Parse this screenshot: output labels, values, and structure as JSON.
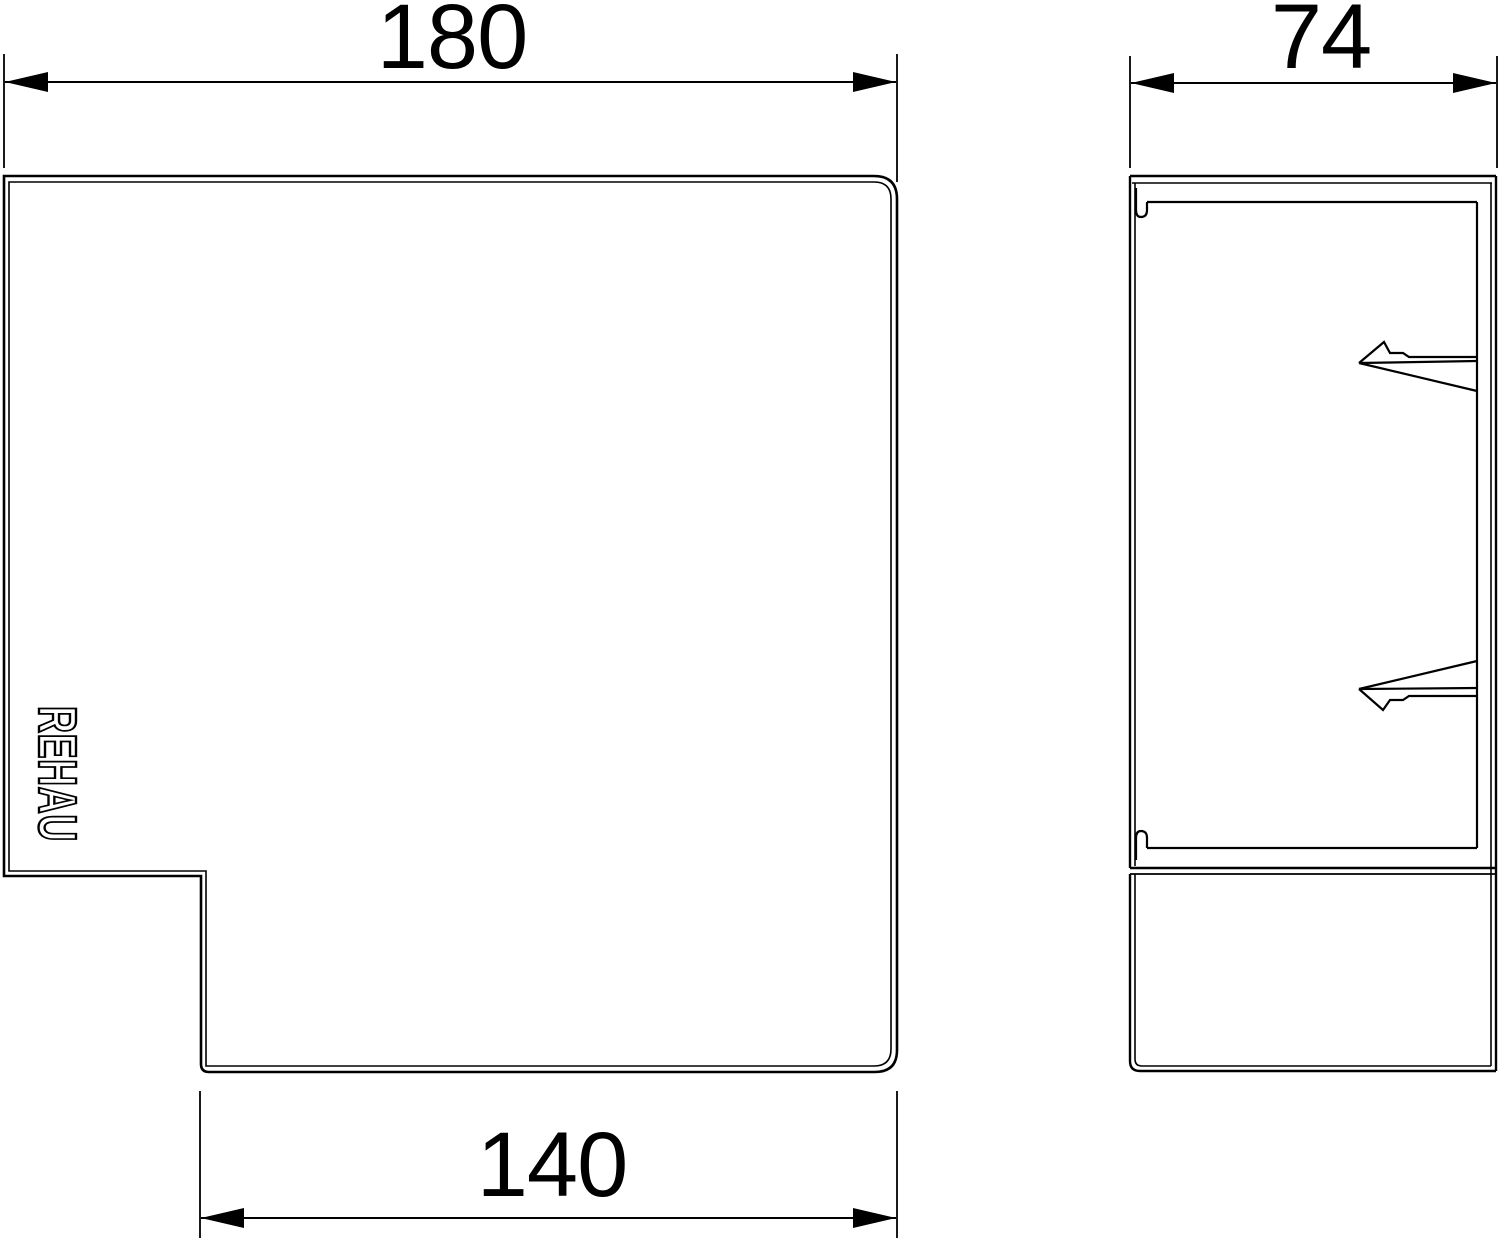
{
  "drawing": {
    "background_color": "#ffffff",
    "line_color": "#000000",
    "front_view": {
      "top_dimension": "180",
      "bottom_dimension": "140",
      "logo_text": "REHAU"
    },
    "side_view": {
      "top_dimension": "74"
    }
  }
}
